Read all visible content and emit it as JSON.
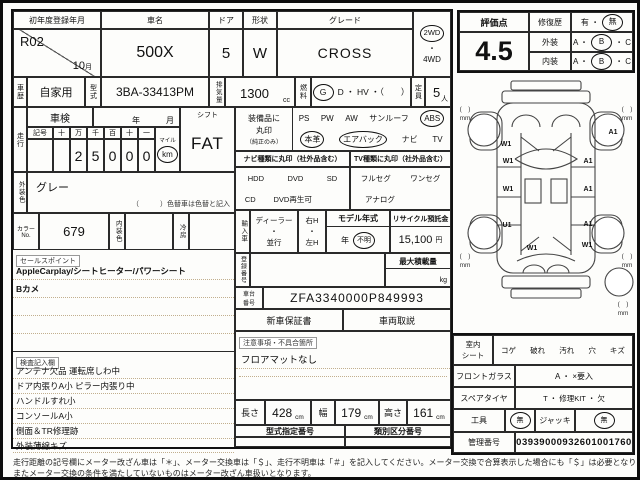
{
  "header": {
    "first_reg_label": "初年度登録年月",
    "first_reg_value": "R02",
    "first_reg_month": "10",
    "month_suffix": "月",
    "name_label": "車名",
    "name_value": "500X",
    "doors_label": "ドア",
    "doors_value": "5",
    "shape_label": "形状",
    "shape_value": "W",
    "grade_label": "グレード",
    "grade_value": "CROSS",
    "drive_top": "2WD",
    "drive_dot": "・",
    "drive_bottom": "4WD"
  },
  "vehicle": {
    "history_label": "車歴",
    "history_value": "自家用",
    "model_label": "型式",
    "model_value": "3BA-33413PM",
    "disp_label": "排気量",
    "disp_value": "1300",
    "disp_unit": "cc",
    "fuel_label": "燃料",
    "fuel_circled": "G",
    "fuel_rest": "D ・ HV ・（　　）",
    "capacity_label": "定員",
    "capacity_value": "5",
    "capacity_unit": "人"
  },
  "shaken": {
    "label": "車検",
    "year": "年",
    "month": "月"
  },
  "mileage": {
    "label": "走行",
    "sign": "記号",
    "cols": [
      "十",
      "万",
      "千",
      "百",
      "十",
      "一"
    ],
    "digits": [
      "",
      "2",
      "5",
      "0",
      "0",
      "0"
    ],
    "unit_top": "マイル",
    "unit_circled": "km"
  },
  "shift": {
    "label": "シフト",
    "value": "FAT"
  },
  "equipment": {
    "label_1": "装備品に",
    "label_2": "丸印",
    "label_3": "（純正のみ）",
    "row1": [
      "PS",
      "PW",
      "AW",
      "サンルーフ",
      "ABS"
    ],
    "row2": [
      "本革",
      "エアバック",
      "ナビ",
      "TV"
    ],
    "circled": [
      "ABS",
      "本革",
      "エアバック"
    ]
  },
  "navtv": {
    "nav_header": "ナビ種類に丸印（社外品含む）",
    "tv_header": "TV種類に丸印（社外品含む）",
    "nav_row1": [
      "HDD",
      "DVD",
      "SD"
    ],
    "nav_row2": [
      "CD",
      "DVD再生可"
    ],
    "tv_row1": [
      "フルセグ",
      "ワンセグ"
    ],
    "tv_row2": [
      "アナログ"
    ]
  },
  "exterior_color": {
    "label": "外装色",
    "value": "グレー",
    "note": "（　　　）色替車は色替と記入"
  },
  "color_row": {
    "color_no_label_1": "カラー",
    "color_no_label_2": "No.",
    "color_no_value": "679",
    "interior_label": "内装色",
    "ac_label": "冷房"
  },
  "importer": {
    "label": "輸入車",
    "dealer": "ディーラー",
    "dot": "・",
    "parallel": "並行",
    "right_h": "右H",
    "left_h": "左H",
    "model_year_header": "モデル年式",
    "year_suffix": "年",
    "year_value": "不明",
    "recycle_header": "リサイクル預託金",
    "recycle_value": "15,100",
    "recycle_unit": "円"
  },
  "registration": {
    "label": "登録番号",
    "max_load_header": "最大積載量",
    "max_load_unit": "kg"
  },
  "chassis": {
    "label_1": "車台",
    "label_2": "番号",
    "value": "ZFA3340000P849993"
  },
  "documents": {
    "warranty": "新車保証書",
    "manual": "車両取説"
  },
  "caution": {
    "tag": "注意事項・不具合箇所",
    "line_1": "フロアマットなし"
  },
  "sales_points": {
    "tag": "セールスポイント",
    "lines": [
      "AppleCarplay/シートヒーター/パワーシート",
      "Bカメ"
    ]
  },
  "inspection_notes": {
    "tag": "検査記入欄",
    "lines": [
      "アンテナ欠品 運転席しわ中",
      "ドア内張りA小 ピラー内張り中",
      "ハンドルすれ小",
      "コンソールA小",
      "側面＆TR修理跡",
      "外装薄線キズ"
    ]
  },
  "dimensions": {
    "length_label": "長さ",
    "length_value": "428",
    "width_label": "幅",
    "width_value": "179",
    "height_label": "高さ",
    "height_value": "161",
    "unit": "cm"
  },
  "type_numbers": {
    "type_header": "型式指定番号",
    "class_header": "類別区分番号"
  },
  "evaluation": {
    "score_label": "評価点",
    "score": "4.5",
    "repair_label": "修復歴",
    "repair_pre": "有 ・",
    "repair_circled": "無",
    "exterior_label": "外装",
    "interior_label": "内装",
    "grade_pre": "A ・",
    "grade_circled": "B",
    "grade_post": "・ C"
  },
  "seat": {
    "label_1": "室内",
    "label_2": "シート",
    "items": [
      "コゲ",
      "破れ",
      "汚れ",
      "穴",
      "キズ"
    ]
  },
  "front_glass": {
    "label": "フロントガラス",
    "value": "A ・ ×要入"
  },
  "spare_tire": {
    "label": "スペアタイヤ",
    "value": "T ・ 修理KIT ・ 欠"
  },
  "tools": {
    "tool_label": "工具",
    "tool_value": "無",
    "jack_label": "ジャッキ",
    "jack_value": "無"
  },
  "control": {
    "label": "管理番号",
    "value": "03939000932601001760"
  },
  "diagram": {
    "bracket": "(　)",
    "unit": "mm",
    "marks": [
      {
        "t": "W1",
        "x": 51,
        "y": 71
      },
      {
        "t": "W1",
        "x": 53,
        "y": 88
      },
      {
        "t": "W1",
        "x": 53,
        "y": 116
      },
      {
        "t": "U1",
        "x": 52,
        "y": 152
      },
      {
        "t": "W1",
        "x": 77,
        "y": 175
      },
      {
        "t": "W1",
        "x": 132,
        "y": 172
      },
      {
        "t": "A1",
        "x": 158,
        "y": 59
      },
      {
        "t": "A1",
        "x": 133,
        "y": 88
      },
      {
        "t": "A1",
        "x": 133,
        "y": 116
      },
      {
        "t": "A1",
        "x": 133,
        "y": 151
      }
    ],
    "corners": [
      {
        "x": 10,
        "y": 36
      },
      {
        "x": 172,
        "y": 36
      },
      {
        "x": 10,
        "y": 183
      },
      {
        "x": 172,
        "y": 183
      },
      {
        "x": 168,
        "y": 231
      }
    ]
  },
  "footer": {
    "line_1": "走行距離の記号欄にメーター改ざん車は「＊」、メーター交換車は「＄」、走行不明車は「＃」を記入してください。メーター交換で合算表示した場合にも「＄」は必要となります。",
    "line_2": "またメーター交換の条件を満たしていないものはメーター改ざん車扱いとなります。"
  }
}
